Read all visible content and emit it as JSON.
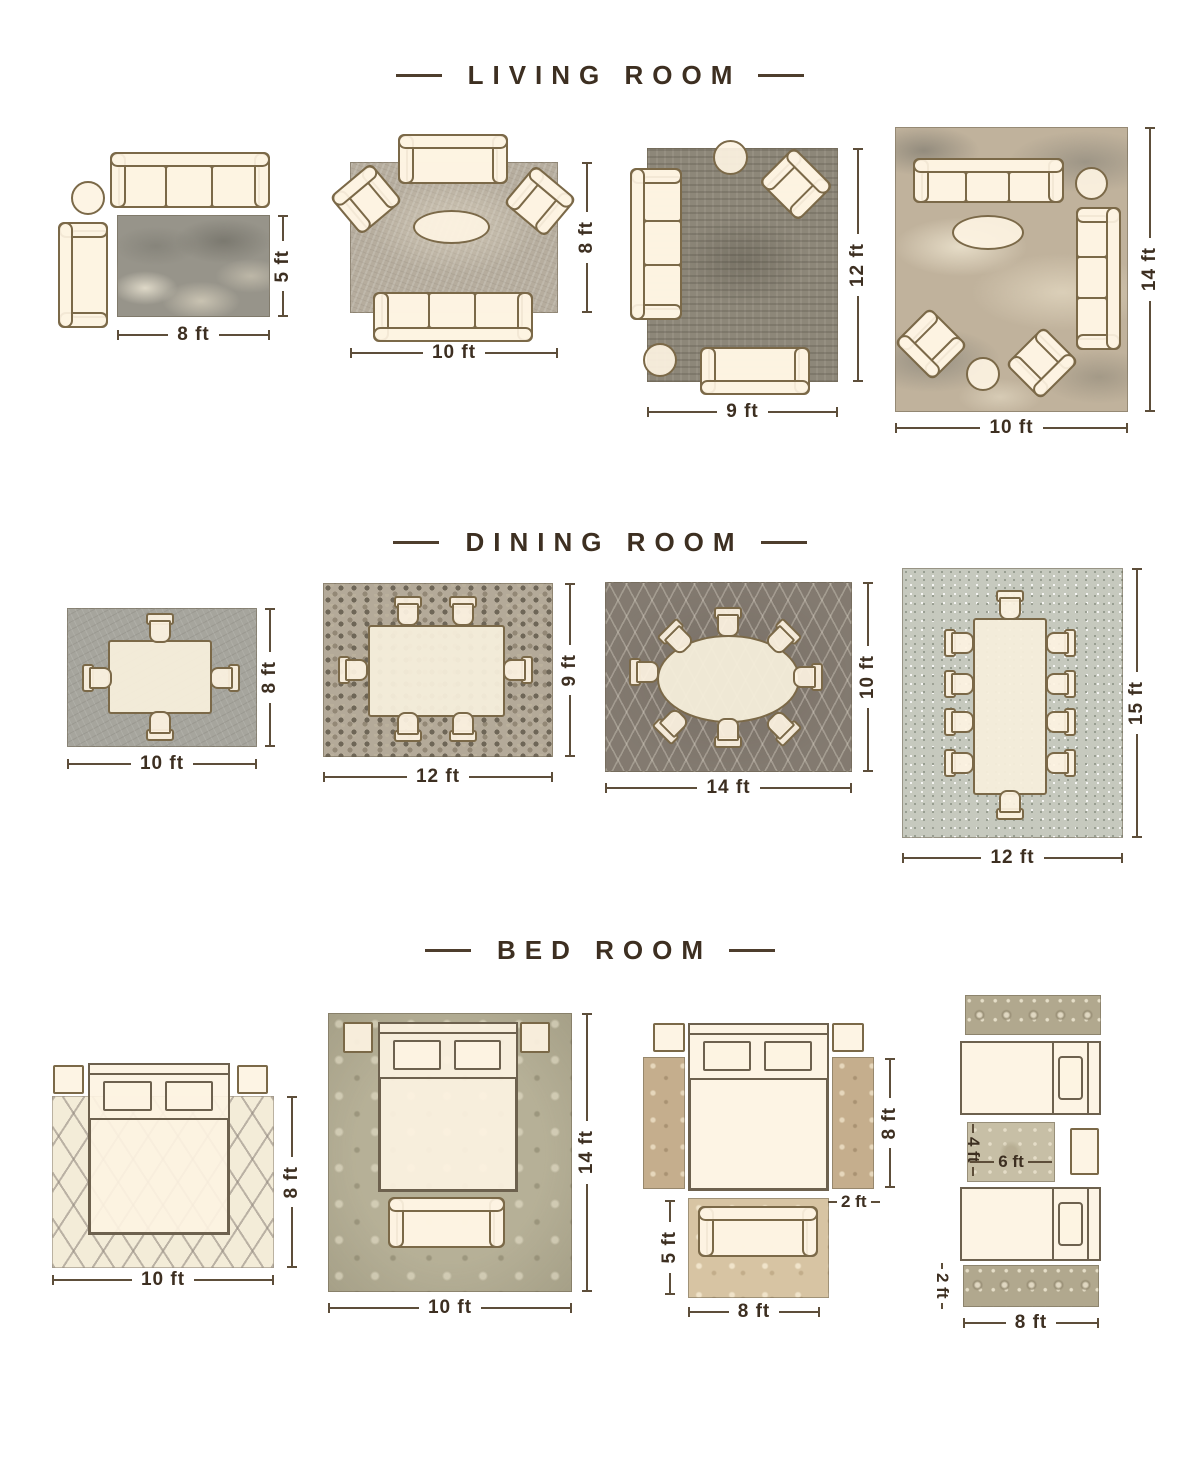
{
  "palette": {
    "background": "#ffffff",
    "title_text": "#3d2f21",
    "dimension_text": "#3d2f21",
    "dimension_line": "#5d4e3a",
    "furniture_fill": "#fdf3e2",
    "furniture_outline": "#7b6948"
  },
  "sections": [
    {
      "title": "LIVING ROOM",
      "layouts": [
        {
          "w": "8 ft",
          "h": "5 ft"
        },
        {
          "w": "10 ft",
          "h": "8 ft"
        },
        {
          "w": "9 ft",
          "h": "12 ft"
        },
        {
          "w": "10 ft",
          "h": "14 ft"
        }
      ]
    },
    {
      "title": "DINING ROOM",
      "layouts": [
        {
          "w": "10 ft",
          "h": "8 ft"
        },
        {
          "w": "12 ft",
          "h": "9 ft"
        },
        {
          "w": "14 ft",
          "h": "10 ft"
        },
        {
          "w": "12 ft",
          "h": "15 ft"
        }
      ]
    },
    {
      "title": "BED ROOM",
      "layouts": [
        {
          "w": "10 ft",
          "h": "8 ft"
        },
        {
          "w": "10 ft",
          "h": "14 ft"
        },
        {
          "runner_length": "8 ft",
          "runner_width": "2 ft",
          "foot_rug_h": "5 ft",
          "foot_rug_w": "8 ft"
        },
        {
          "center_rug_h": "4 ft",
          "center_rug_w": "6 ft",
          "runner_h": "2 ft",
          "runner_w": "8 ft"
        }
      ]
    }
  ]
}
